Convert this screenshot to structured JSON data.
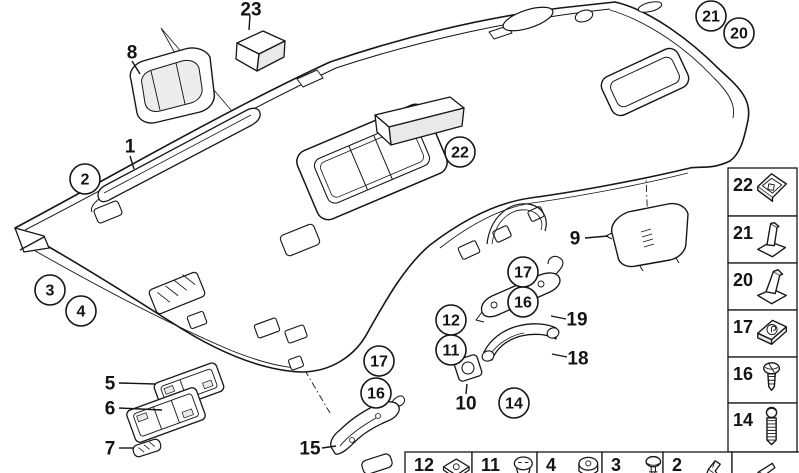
{
  "colors": {
    "line": "#161616",
    "fill": "#ffffff",
    "shade": "#e9e9e9"
  },
  "callouts": {
    "circled": [
      {
        "label": "2",
        "x": 85,
        "y": 179
      },
      {
        "label": "3",
        "x": 50,
        "y": 290
      },
      {
        "label": "4",
        "x": 81,
        "y": 311
      },
      {
        "label": "22",
        "x": 460,
        "y": 152
      },
      {
        "label": "21",
        "x": 711,
        "y": 16
      },
      {
        "label": "20",
        "x": 739,
        "y": 33
      },
      {
        "label": "17",
        "x": 523,
        "y": 272
      },
      {
        "label": "16",
        "x": 523,
        "y": 302
      },
      {
        "label": "12",
        "x": 451,
        "y": 320
      },
      {
        "label": "11",
        "x": 451,
        "y": 350
      },
      {
        "label": "17",
        "x": 379,
        "y": 361
      },
      {
        "label": "16",
        "x": 376,
        "y": 393
      },
      {
        "label": "14",
        "x": 514,
        "y": 403
      }
    ],
    "plain": [
      {
        "label": "23",
        "x": 251,
        "y": 9,
        "leader": [
          250,
          15,
          249,
          30
        ]
      },
      {
        "label": "8",
        "x": 132,
        "y": 52,
        "leader": [
          132,
          61,
          140,
          74
        ]
      },
      {
        "label": "1",
        "x": 130,
        "y": 146,
        "leader": [
          130,
          156,
          134,
          169
        ]
      },
      {
        "label": "9",
        "x": 575,
        "y": 238,
        "leader": [
          585,
          238,
          608,
          236
        ]
      },
      {
        "label": "19",
        "x": 577,
        "y": 319,
        "leader": [
          566,
          319,
          551,
          316
        ]
      },
      {
        "label": "18",
        "x": 578,
        "y": 358,
        "leader": [
          567,
          357,
          552,
          354
        ]
      },
      {
        "label": "10",
        "x": 466,
        "y": 403,
        "leader": [
          466,
          394,
          467,
          384
        ]
      },
      {
        "label": "15",
        "x": 310,
        "y": 448,
        "leader": [
          322,
          448,
          336,
          446
        ]
      },
      {
        "label": "5",
        "x": 110,
        "y": 383,
        "leader": [
          119,
          383,
          155,
          384
        ]
      },
      {
        "label": "6",
        "x": 110,
        "y": 408,
        "leader": [
          119,
          408,
          162,
          410
        ]
      },
      {
        "label": "7",
        "x": 110,
        "y": 448,
        "leader": [
          119,
          448,
          133,
          448
        ]
      }
    ]
  },
  "sidebar": {
    "x1": 728,
    "x2": 797,
    "rows": [
      {
        "label": "22",
        "y1": 168,
        "y2": 216,
        "icon": "plate-clip"
      },
      {
        "label": "21",
        "y1": 216,
        "y2": 263,
        "icon": "wedge-bracket-l"
      },
      {
        "label": "20",
        "y1": 263,
        "y2": 310,
        "icon": "wedge-bracket-r"
      },
      {
        "label": "17",
        "y1": 310,
        "y2": 357,
        "icon": "spring-clip"
      },
      {
        "label": "16",
        "y1": 357,
        "y2": 403,
        "icon": "screw-short"
      },
      {
        "label": "14",
        "y1": 403,
        "y2": 452,
        "icon": "screw-long"
      }
    ]
  },
  "bottom_strip": {
    "y": 452,
    "cells": [
      {
        "label": "12",
        "x1": 405,
        "x2": 472,
        "icon": "clip-nut"
      },
      {
        "label": "11",
        "x1": 472,
        "x2": 537,
        "icon": "rivet"
      },
      {
        "label": "4",
        "x1": 537,
        "x2": 602,
        "icon": "grommet"
      },
      {
        "label": "3",
        "x1": 602,
        "x2": 663,
        "icon": "push-pin"
      },
      {
        "label": "2",
        "x1": 663,
        "x2": 732,
        "icon": "angle-clip"
      },
      {
        "label": "",
        "x1": 732,
        "x2": 800,
        "icon": "folded-strip"
      }
    ]
  }
}
